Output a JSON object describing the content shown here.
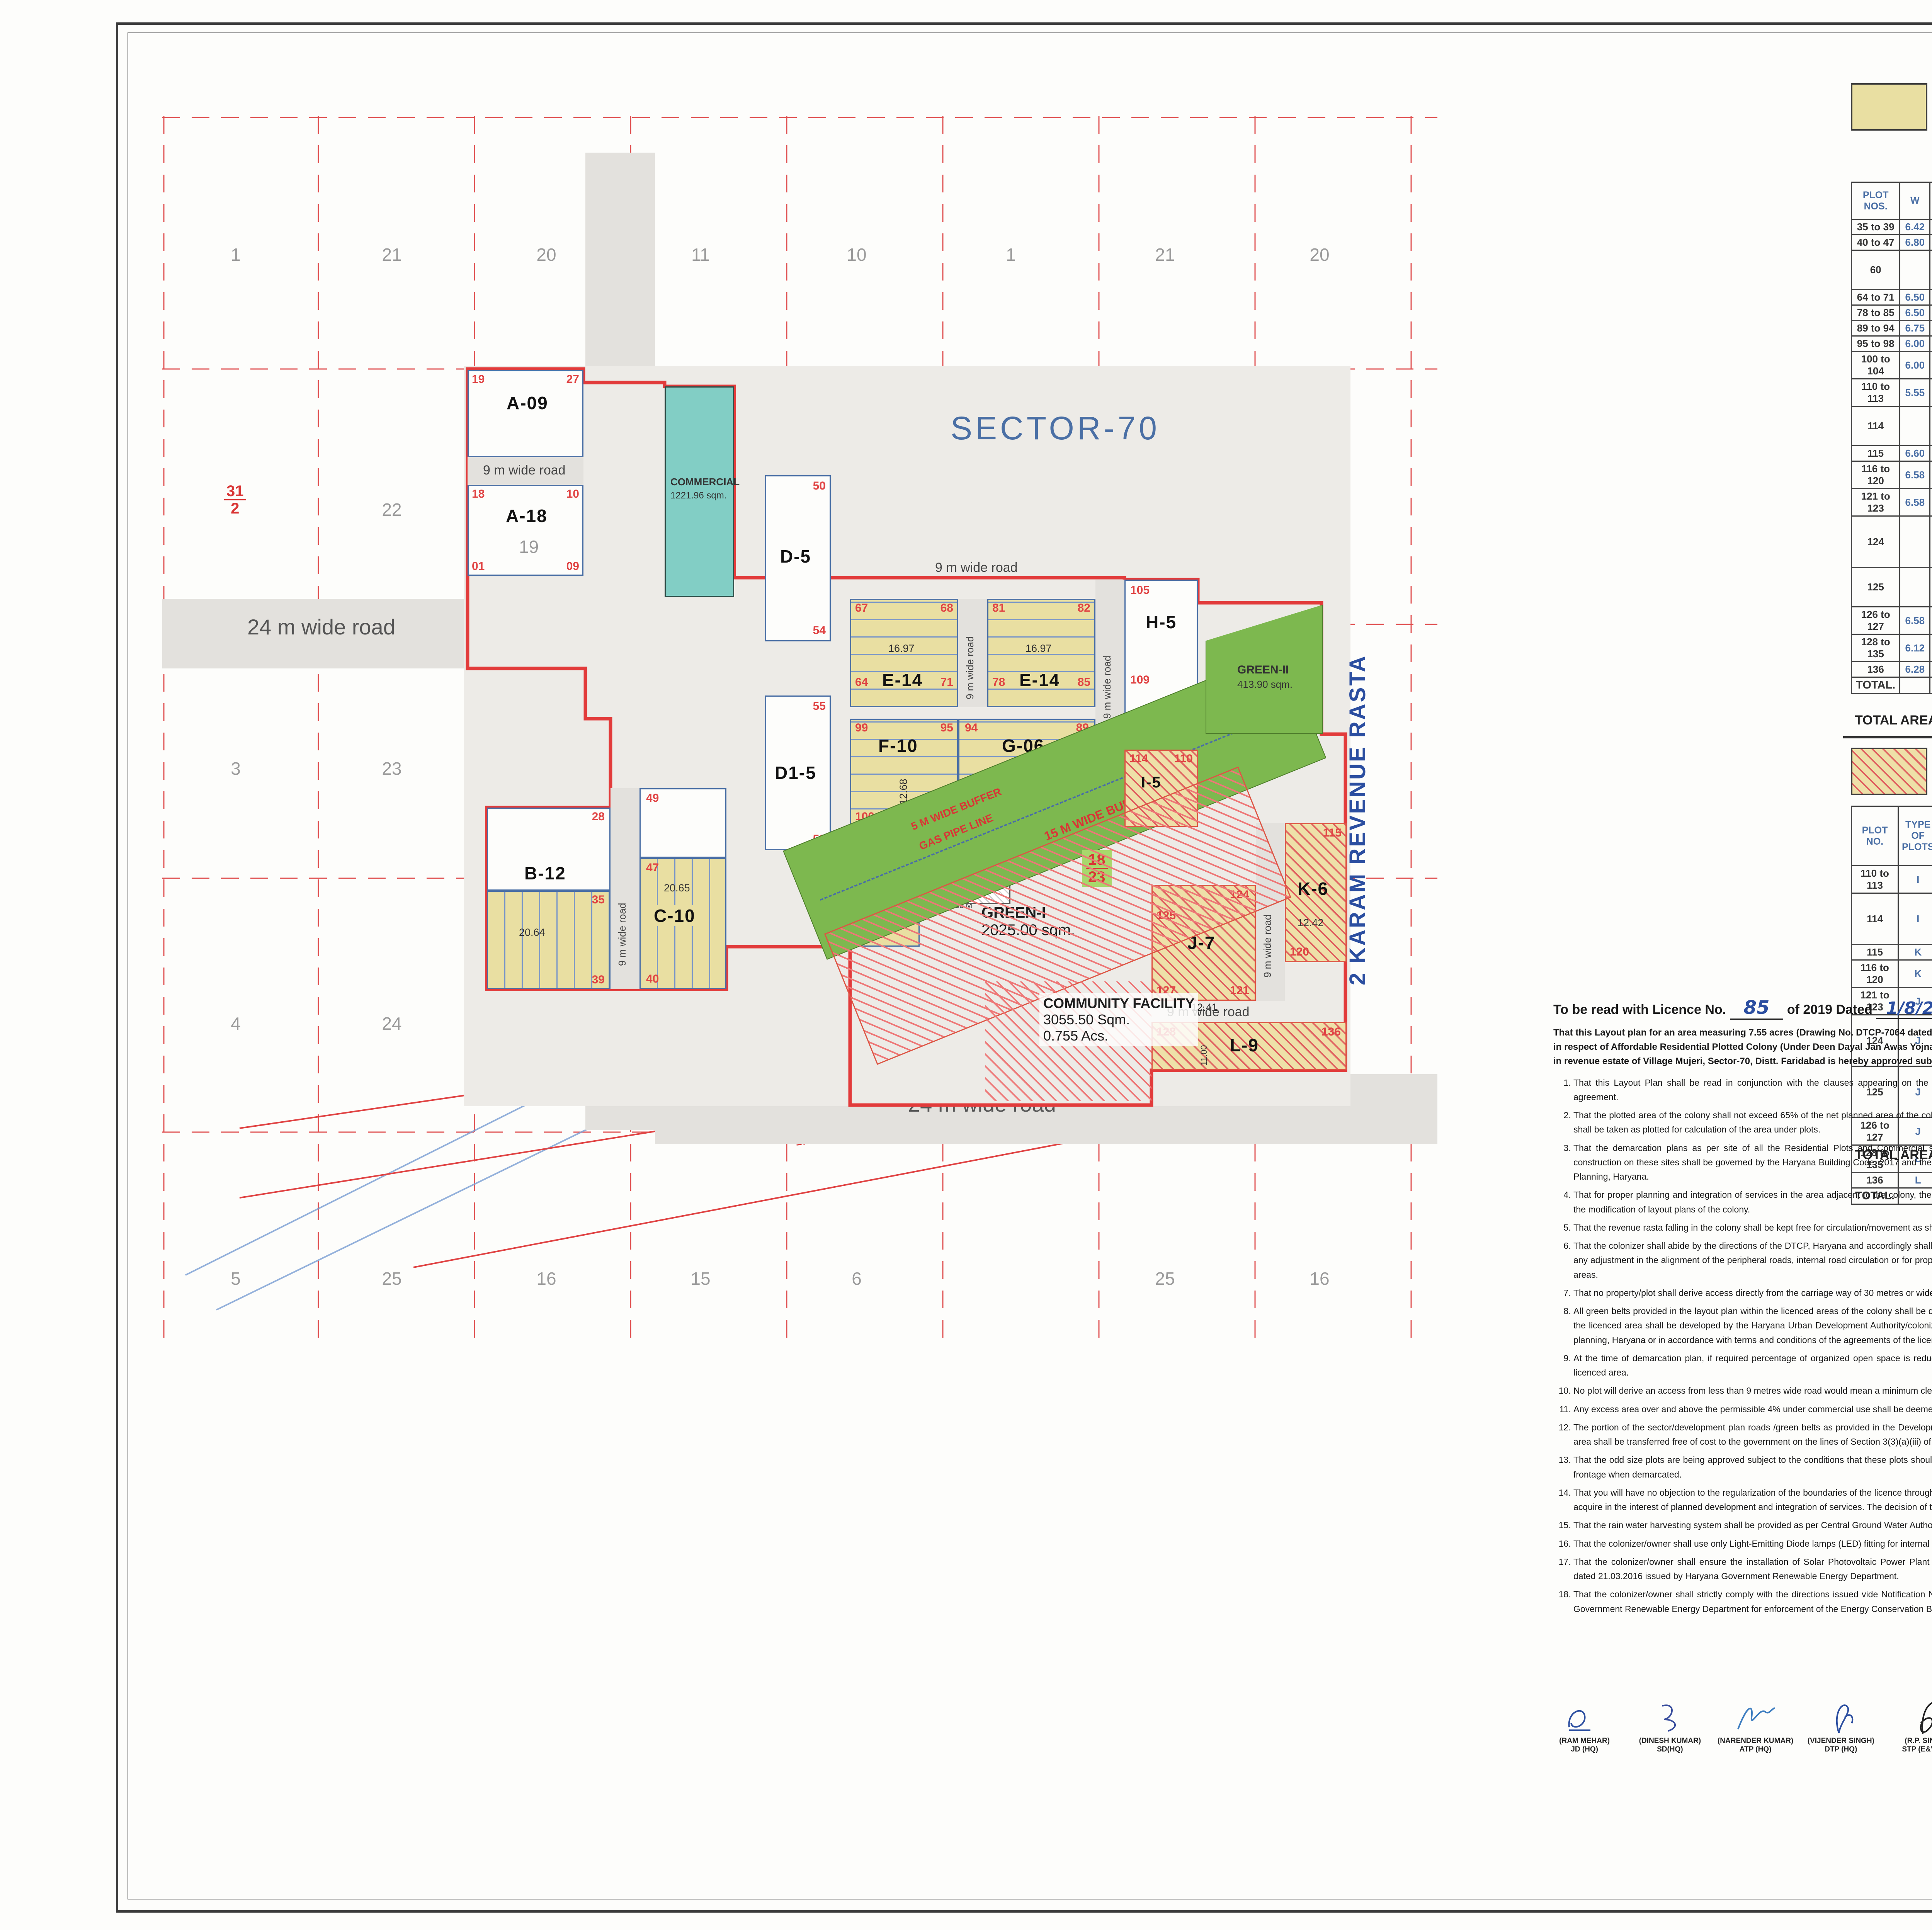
{
  "map": {
    "sector_label": "SECTOR-70",
    "rasta_label": "2 KARAM REVENUE RASTA",
    "road24": "24 m wide road",
    "road9": "9 m wide road",
    "buffer1750": "17.50 M WIDE BUFFER",
    "ht_line": "HT.LINE 220 K.V.",
    "buffer5": "5 M WIDE BUFFER",
    "gas_pipe": "GAS PIPE LINE",
    "buffer15": "15 M WIDE BUFFER",
    "khasra": {
      "row1": [
        "1",
        "21",
        "20",
        "11",
        "10",
        "1",
        "21",
        "20"
      ],
      "row2": [
        "22",
        "12",
        "2",
        "22",
        "19"
      ],
      "row3": [
        "3",
        "23",
        "18",
        "18"
      ],
      "row4": [
        "4",
        "24",
        "17",
        "14",
        "7",
        "24",
        "17"
      ],
      "row5": [
        "5",
        "25",
        "16",
        "15",
        "6",
        "25",
        "16"
      ],
      "f1": {
        "t": "31",
        "b": "2"
      },
      "f2": {
        "t": "21",
        "b": "13"
      },
      "f3": {
        "t": "18",
        "b": "23"
      }
    },
    "blocks": {
      "a09": {
        "label": "A-09",
        "c1": "19",
        "c2": "27"
      },
      "a18": {
        "label": "A-18",
        "c1": "18",
        "c2": "10",
        "c3": "01",
        "c4": "09",
        "kh": "19"
      },
      "commercial": {
        "l1": "COMMERCIAL",
        "l2": "1221.96 sqm."
      },
      "d5": {
        "label": "D-5",
        "n1": "50",
        "n2": "54"
      },
      "d15": {
        "label": "D1-5",
        "n1": "55",
        "n2": "59"
      },
      "e14a": {
        "label": "E-14",
        "n1": "67",
        "n2": "68",
        "n3": "64",
        "n4": "71",
        "dim": "16.97"
      },
      "e14b": {
        "label": "E-14",
        "n1": "81",
        "n2": "82",
        "n3": "78",
        "n4": "85",
        "dim": "16.97"
      },
      "h5": {
        "label": "H-5",
        "n1": "105",
        "n2": "109"
      },
      "b12": {
        "label": "B-12",
        "n1": "28",
        "n2": "35",
        "n3": "39",
        "dim": "20.64"
      },
      "c10": {
        "label": "C-10",
        "n1": "49",
        "n2": "47",
        "n3": "40",
        "dim": "20.65"
      },
      "f10": {
        "label": "F-10",
        "n1": "99",
        "n2": "95",
        "n3": "100",
        "n4": "104",
        "dim": "12.68"
      },
      "g06": {
        "label": "G-06",
        "n1": "94",
        "n2": "89",
        "dim": "14.10"
      },
      "g101": {
        "label": "G1-01",
        "n1": "60",
        "dim1": "14.00",
        "dim2": "13.19",
        "dim3": "6.70"
      },
      "i5": {
        "label": "I-5",
        "n1": "114",
        "n2": "110"
      },
      "j7": {
        "label": "J-7",
        "n1": "124",
        "n2": "125",
        "n3": "127",
        "n4": "121",
        "dim": "12.41"
      },
      "k6": {
        "label": "K-6",
        "n1": "115",
        "n2": "120",
        "dim": "12.42"
      },
      "l9": {
        "label": "L-9",
        "n1": "128",
        "n2": "136",
        "dim": "11.00"
      },
      "green1": {
        "l1": "GREEN-I",
        "l2": "2025.00 sqm."
      },
      "green2": {
        "l1": "GREEN-II",
        "l2": "413.90 sqm."
      },
      "community": {
        "l1": "COMMUNITY FACILITY",
        "l2": "3055.50 Sqm.",
        "l3": "0.755 Acs."
      },
      "ugt": {
        "l1": "UGT",
        "l2": "100 sqm."
      },
      "ugstp": {
        "l1": "UG",
        "l2": "STP",
        "l3": "150 sqm."
      },
      "milk": "MILK VEG. BOOTH",
      "et": {
        "l1": "E.T.",
        "l2": "3.50 x 3.50 M"
      }
    }
  },
  "freeze_legend": {
    "line1": "Area Freezed 51.11 % (13819.05 sqm of",
    "line2": "Total Saleable Area.)"
  },
  "table1": {
    "headers": [
      "PLOT NOS.",
      "W",
      "D",
      "AREA OF PLOTS IN SQM.",
      "NO OF PLOTS",
      "AREA UNDER PLOTS"
    ],
    "rows": [
      [
        "35 to 39",
        "6.42",
        "20.64",
        "132.51",
        "5",
        "662.54"
      ],
      [
        "40 to 47",
        "6.80",
        "20.65",
        "140.42",
        "8",
        "1123.36"
      ],
      [
        "60",
        "",
        "",
        "14.00 x 6.70 + 13.19 /2",
        "1",
        "139.23"
      ],
      [
        "64 to 71",
        "6.50",
        "16.97",
        "110.31",
        "8",
        "882.44"
      ],
      [
        "78 to 85",
        "6.50",
        "16.97",
        "110.31",
        "8",
        "882.44"
      ],
      [
        "89 to 94",
        "6.75",
        "14.10",
        "95.18",
        "6",
        "571.05"
      ],
      [
        "95 to 98",
        "6.00",
        "12.68",
        "76.08",
        "4",
        "304.32"
      ],
      [
        "100 to 104",
        "6.00",
        "12.68",
        "76.08",
        "5",
        "380.40"
      ],
      [
        "110 to 113",
        "5.55",
        "11.97",
        "66.43",
        "4",
        "265.73"
      ],
      [
        "114",
        "",
        "",
        "8.55 x 11.97 - 3.0 x 1.83/2",
        "1",
        "99.59"
      ],
      [
        "115",
        "6.60",
        "12.42",
        "81.97",
        "1",
        "81.97"
      ],
      [
        "116 to 120",
        "6.58",
        "12.42",
        "81.72",
        "5",
        "408.62"
      ],
      [
        "121 to 123",
        "6.58",
        "12.41",
        "81.66",
        "3",
        "244.97"
      ],
      [
        "124",
        "",
        "",
        "10.16 x 12.41 - 2.86 x 4.57/2",
        "1",
        "119.55"
      ],
      [
        "125",
        "",
        "",
        "12.41 X 6.43 + 13.88/2",
        "1",
        "126.02"
      ],
      [
        "126 to 127",
        "6.58",
        "12.41",
        "81.66",
        "2",
        "163.32"
      ],
      [
        "128 to 135",
        "6.12",
        "11.00",
        "67.32",
        "8",
        "538.56"
      ],
      [
        "136",
        "6.28",
        "11.00",
        "69.08",
        "1",
        "69.08"
      ],
      [
        "TOTAL.",
        "",
        "",
        "",
        "72",
        "7063.20"
      ]
    ],
    "acs": "(1.7453 Acs.)",
    "formula": "TOTAL AREA = 7063.20 X 100 / 13819.05 = 51.11 %"
  },
  "mortgage_legend": {
    "line1": "15.32 % Area (13819.05 sqm. of Total Saleable area)",
    "line2": "Mortgaged in Favour of DTCP Haryana."
  },
  "table2": {
    "headers": [
      "PLOT NO.",
      "TYPE OF PLOTS",
      "W",
      "D",
      "AREA OF PLOTS IN SQM.",
      "NO OF PLOTS",
      "AREA UNDER PLOTS"
    ],
    "rows": [
      [
        "110 to 113",
        "I",
        "5.55",
        "11.97",
        "66.43",
        "4",
        "265.73"
      ],
      [
        "114",
        "I",
        "",
        "",
        "8.55 x 11.97 - 3.0 x 1.83/2",
        "1",
        "99.59"
      ],
      [
        "115",
        "K",
        "6.60",
        "12.42",
        "81.97",
        "1",
        "81.97"
      ],
      [
        "116 to 120",
        "K",
        "6.58",
        "12.42",
        "81.72",
        "5",
        "408.62"
      ],
      [
        "121 to 123",
        "J",
        "6.58",
        "12.41",
        "81.66",
        "3",
        "244.97"
      ],
      [
        "124",
        "J",
        "",
        "",
        "10.16 x 12.41 - 2.86 x 4.57/2",
        "1",
        "119.55"
      ],
      [
        "125",
        "J",
        "",
        "",
        "12.41 X 6.43 + 13.88/2",
        "1",
        "126.02"
      ],
      [
        "126 to 127",
        "J",
        "6.58",
        "12.41",
        "81.66",
        "2",
        "163.32"
      ],
      [
        "128 to 135",
        "L",
        "6.12",
        "11.00",
        "67.32",
        "8",
        "538.56"
      ],
      [
        "136",
        "L",
        "6.28",
        "11.00",
        "69.08",
        "1",
        "69.08"
      ],
      [
        "TOTAL.",
        "",
        "",
        "",
        "",
        "27",
        "2117.41"
      ]
    ],
    "acs": "(0.5232 Acs.)",
    "formula": "TOTAL AREA = 2117.41 X 100 / 13819.05 = 15.32 %"
  },
  "area_statement": {
    "title": "AREA STATEMENT :",
    "h_desc": "DESCRIPTION",
    "h_sqm1": "AREA IN",
    "h_sqm2": "SQ.METER",
    "h_ac1": "AREA IN",
    "h_ac2": "ACRES",
    "h_ach": "AREA ACHIEVED",
    "h_perm": "AREA PERMISSIABLE",
    "r1": {
      "desc": "TOTAL AREA OF THE SCHEME",
      "sqm": "30553.717",
      "ac": "7.55",
      "ach": "—",
      "perm": "65%"
    },
    "r2": {
      "desc": "A - AREA UNDER PLOTS",
      "sqm": "13819.05",
      "ac": "3.414",
      "ach": "45.22 %"
    },
    "r3": {
      "desc": "B - AREA UNDER COMMERCIAL",
      "sqm": "1221.96",
      "ac": "0.30195",
      "ach": "4.00 %"
    },
    "ach1": "ACHIEVED",
    "ach2": "(A+B)",
    "ach3": "49.22%"
  },
  "detail_plots": {
    "title": "DETAIL OF PLOTS",
    "headers": [
      "TYPE OF PLOTS",
      "W",
      "D",
      "AREA OF PLOTS IN SQM.",
      "NO OF PLOTS",
      "AREA UNDER PLOTS"
    ],
    "rows": [
      [
        "A",
        "6.15",
        "15.83",
        "97.35",
        "27",
        "2628.57"
      ],
      [
        "B",
        "6.42",
        "20.64",
        "132.51",
        "12",
        "1590.11"
      ],
      [
        "C",
        "6.80",
        "20.65",
        "140.42",
        "10",
        "1404.20"
      ],
      [
        "D",
        "7.40",
        "17.29",
        "127.95",
        "5",
        "639.73"
      ],
      [
        "D1",
        "6.87",
        "17.29",
        "118.78",
        "5",
        "593.91"
      ],
      [
        "E",
        "6.50",
        "16.97",
        "110.31",
        "28",
        "3088.54"
      ],
      [
        "F",
        "6.00",
        "12.68",
        "76.08",
        "10",
        "760.80"
      ],
      [
        "G",
        "6.75",
        "14.10",
        "95.18",
        "6",
        "571.05"
      ],
      [
        "G1",
        "6.70",
        "14.00",
        "93.80",
        "1",
        "93.80"
      ],
      [
        "H",
        "6.10",
        "14.70",
        "89.67",
        "5",
        "448.35"
      ],
      [
        "I",
        "5.55",
        "11.97",
        "66.43",
        "5",
        "332.17"
      ],
      [
        "J",
        "6.58",
        "12.41",
        "81.66",
        "7",
        "571.60"
      ],
      [
        "K",
        "6.58",
        "12.42",
        "81.72",
        "6",
        "490.34"
      ],
      [
        "L",
        "6.12",
        "11.00",
        "67.32",
        "9",
        "605.88"
      ],
      [
        "TOTAL.",
        "",
        "",
        "",
        "136",
        "13819.05"
      ]
    ],
    "note": "TOTAL AREA UNDER PLOTS = 3.414 ACS."
  },
  "detail_green": {
    "title": "DETAIL OF GREEN",
    "h1": "AREA IN SQMTR.",
    "h2": "AREA IN ACS.",
    "h3": "AREA PROVIDE",
    "h4": "AREA REQUIRED",
    "g1": [
      "GREEN-I",
      "2025.00",
      "0.50",
      "6.62 %"
    ],
    "g2": [
      "GREEN-II",
      "413.90",
      "0.102",
      "1.35%"
    ],
    "tot": [
      "TOTAL",
      "2438.90",
      "0.602",
      "7.97 %"
    ],
    "req1": "(2291.53 sqm.)",
    "req2": "7.50 %"
  },
  "community_legend": {
    "line1": "0.755 acres Land Reserved For Community Facilites",
    "line2": "for Transfer to Government."
  },
  "density": {
    "h1": "TOTAL PLOTS",
    "h2": "PERSON PER PLOTS",
    "h3": "TOTAL DENSITY",
    "h4": "PERCENTAGE PER ACRES",
    "v1": "136",
    "v2": "13.5",
    "v3": "1836.00",
    "v4": "1836.00/7.55 = 243.18 PPA",
    "say": "SAY = 243.00 PPA"
  },
  "licence": {
    "lc_no": "LC-4009",
    "prefix": "To be read with Licence No.",
    "hand_no": "85",
    "mid": "of 2019  Dated",
    "hand_date": "1/8/2019.",
    "para": "That this Layout plan for an area measuring 7.55 acres (Drawing No. DTCP-7064 dated 23.07.2019) comprised of licence which is issued in respect of Affordable Residential Plotted Colony (Under Deen Dayal Jan Awas Yojna) being developed by Xsis Infra Concept Pvt. Ltd. in revenue estate of Village Mujeri, Sector-70, Distt. Faridabad is hereby approved subject to the following conditions:-",
    "conditions": [
      "That this Layout Plan shall be read in conjunction with the clauses appearing on the agreement executed under Rule 11 and the bilateral agreement.",
      "That the plotted area of the colony shall not exceed 65% of the net planned area of the colony. The entire area reserved for commercial purposes shall be taken as plotted for calculation of the area under plots.",
      "That the demarcation plans as per site of all the Residential Plots and Commercial site shall be got approved from this Department and construction on these sites shall be governed by the Haryana Building Code, 2017 and the Zoning Plan approved by the Director, Town & Country Planning, Haryana.",
      "That for proper planning and integration of services in the area adjacent to the colony, the colonizer shall abide by the directions of the DTCP for the modification of layout plans of the colony.",
      "That the revenue rasta falling in the colony shall be kept free for circulation/movement as shown in the layout plan.",
      "That the colonizer shall abide by the directions of the DTCP, Haryana and accordingly shall make necessary changes in the layout plan for making any adjustment in the alignment of the peripheral roads, internal road circulation or for proper integration of the planning proposals of the adjoining areas.",
      "That no property/plot shall derive access directly from the carriage way of 30 metres or wider sector road if applicable.",
      "All green belts provided in the layout plan within the licenced areas of the colony shall be developed by the colonizer. All other green belts outside the licenced area shall be developed by the Haryana Urban Development Authority/colonizer on the directions of the Director, Town and Country planning, Haryana or in accordance with terms and conditions of the  agreements of the licence.",
      "At the time of demarcation plan, if required percentage of organized open space is reduced, the same will be provided by the colonizer in the licenced area.",
      "No plot will derive an access from less than 9 metres wide road would mean a minimum clear width of 9 metres between the plots.",
      "Any excess area over and above the permissible 4% under commercial use shall be deemed to be open space.",
      "The portion of the sector/development plan roads /green belts as provided in the Development Plan if applicable, which form part of the licenced area shall be transferred free of cost to the government on the lines of Section 3(3)(a)(iii) of the Act No.8 of 1975.",
      "That the odd size plots are being approved subject to the conditions that these plots should not have a frontage of less than 75% of the standard frontage when demarcated.",
      "That you will have no objection to the regularization of the boundaries of the licence through give and take with the land that HUDA is finally able to acquire in the interest of planned development and integration of services. The decision of the competent authority shall be binding in this regard.",
      "That the rain water harvesting system shall be provided as per Central Ground Water Authority norms/Haryana Govt. notification as applicable.",
      "That the colonizer/owner shall use only Light-Emitting Diode lamps (LED) fitting for internal lighting as well as Campus lighting.",
      "That the colonizer/owner shall ensure the installation of Solar Photovoltaic Power Plant as per the provisions of order No.22/52/2005-5Power dated 21.03.2016 issued by Haryana Government Renewable Energy Department.",
      "That the colonizer/owner shall strictly comply with the directions issued vide Notification No. 19/6/2016-5P dated 31.03.2016 issued by Haryana Government Renewable Energy Department for enforcement of the Energy Conservation Building Codes."
    ]
  },
  "signatories": [
    {
      "name": "(RAM MEHAR)",
      "role": "JD (HQ)"
    },
    {
      "name": "(DINESH KUMAR)",
      "role": "SD(HQ)"
    },
    {
      "name": "(NARENDER KUMAR)",
      "role": "ATP (HQ)"
    },
    {
      "name": "(VIJENDER SINGH)",
      "role": "DTP (HQ)"
    },
    {
      "name": "(R.P. SINGH)",
      "role": "STP (E&V) HR"
    },
    {
      "name": "(JITENDER SIHAG)",
      "role": "CTP(HR)"
    },
    {
      "name": "(K. MAKRAND PANDURANG, IAS)",
      "role": "DTCP (HR)"
    }
  ],
  "authorized": {
    "company": "XSIS INFRA HOME CONCEPTS PRIVATE LIMITED",
    "director": "Director",
    "label": "AUTHORIZED SIGNATORY"
  },
  "architect": {
    "stamp1": "ARCH. RAKESH VASUDEVA",
    "stamp2": "M.C.A. REG. No. CA/94/17500",
    "stamp3": "H. NO. 152, SECTOR-18,",
    "stamp4": "FARIDABAD",
    "label": "ARCHITECT SIGNATURE"
  },
  "north": {
    "label": "N"
  },
  "titleblock": {
    "client_label": "CLIENT:-",
    "client_name": "M/S XSIS INFRA HOME CONCEPTS PVT. LTD.",
    "client_add": "ADD.  SCO NO-42, SECTOR-12 FARIDABAD-121002  INDIA",
    "title1": "LAYOUT PLAN OF AFFORDABLE RESIDENTIAL PLOTTED",
    "title2": "COLONY UNDER (DDJAY) AT SECTOR-70, AREA MEASURING",
    "title3": "7.55 ACS. IN VILLAGE MUJERI, DISTRICT-FARIDABAD, HARYANA.",
    "scale": "SCALE :- 1:1000",
    "date": "DATE:-JULY-2019",
    "drawn1": "DRAWN BY:-PANKAJ KAPOOR",
    "drawn2": "M-8800093157"
  }
}
